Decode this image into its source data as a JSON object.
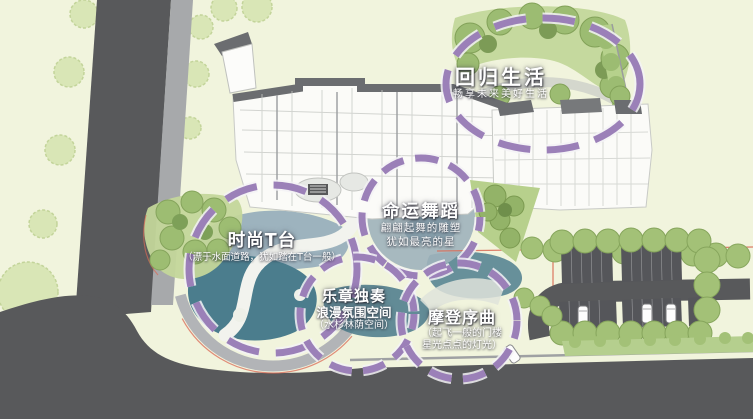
{
  "canvas": {
    "width": 753,
    "height": 419,
    "type": "landscape-master-plan"
  },
  "zones": [
    {
      "id": "return-to-life",
      "title": "回归生活",
      "subtitles": [
        "畅享未来美好生活"
      ]
    },
    {
      "id": "dance-of-destiny",
      "title": "命运舞蹈",
      "subtitles": [
        "翩翩起舞的雕塑",
        "犹如最亮的星"
      ]
    },
    {
      "id": "fashion-runway",
      "title": "时尚T台",
      "subtitles": [
        "（漂于水面道路，犹如踏在T台一般）"
      ]
    },
    {
      "id": "solo-movement",
      "title": "乐章独奏",
      "subtitles": [
        "浪漫氛围空间",
        "（水杉林荫空间）"
      ]
    },
    {
      "id": "modern-overture",
      "title": "摩登序曲",
      "subtitles": [
        "（起飞一般的门楼",
        "星光点点的灯光）"
      ]
    }
  ],
  "colors": {
    "background": "#f1f4dd",
    "road": "#58595b",
    "sidewalk": "#a7a9ab",
    "accent_purple": "#9b80b8",
    "water_teal": "#4b7d8d",
    "water_light": "#9db3be",
    "tree_light": "#d9e6b6",
    "tree_green": "#9dbd72",
    "boundary_red": "#d96a55",
    "building": "#fbfbf8",
    "roof": "#6b6d70",
    "label_text": "#ffffff"
  }
}
